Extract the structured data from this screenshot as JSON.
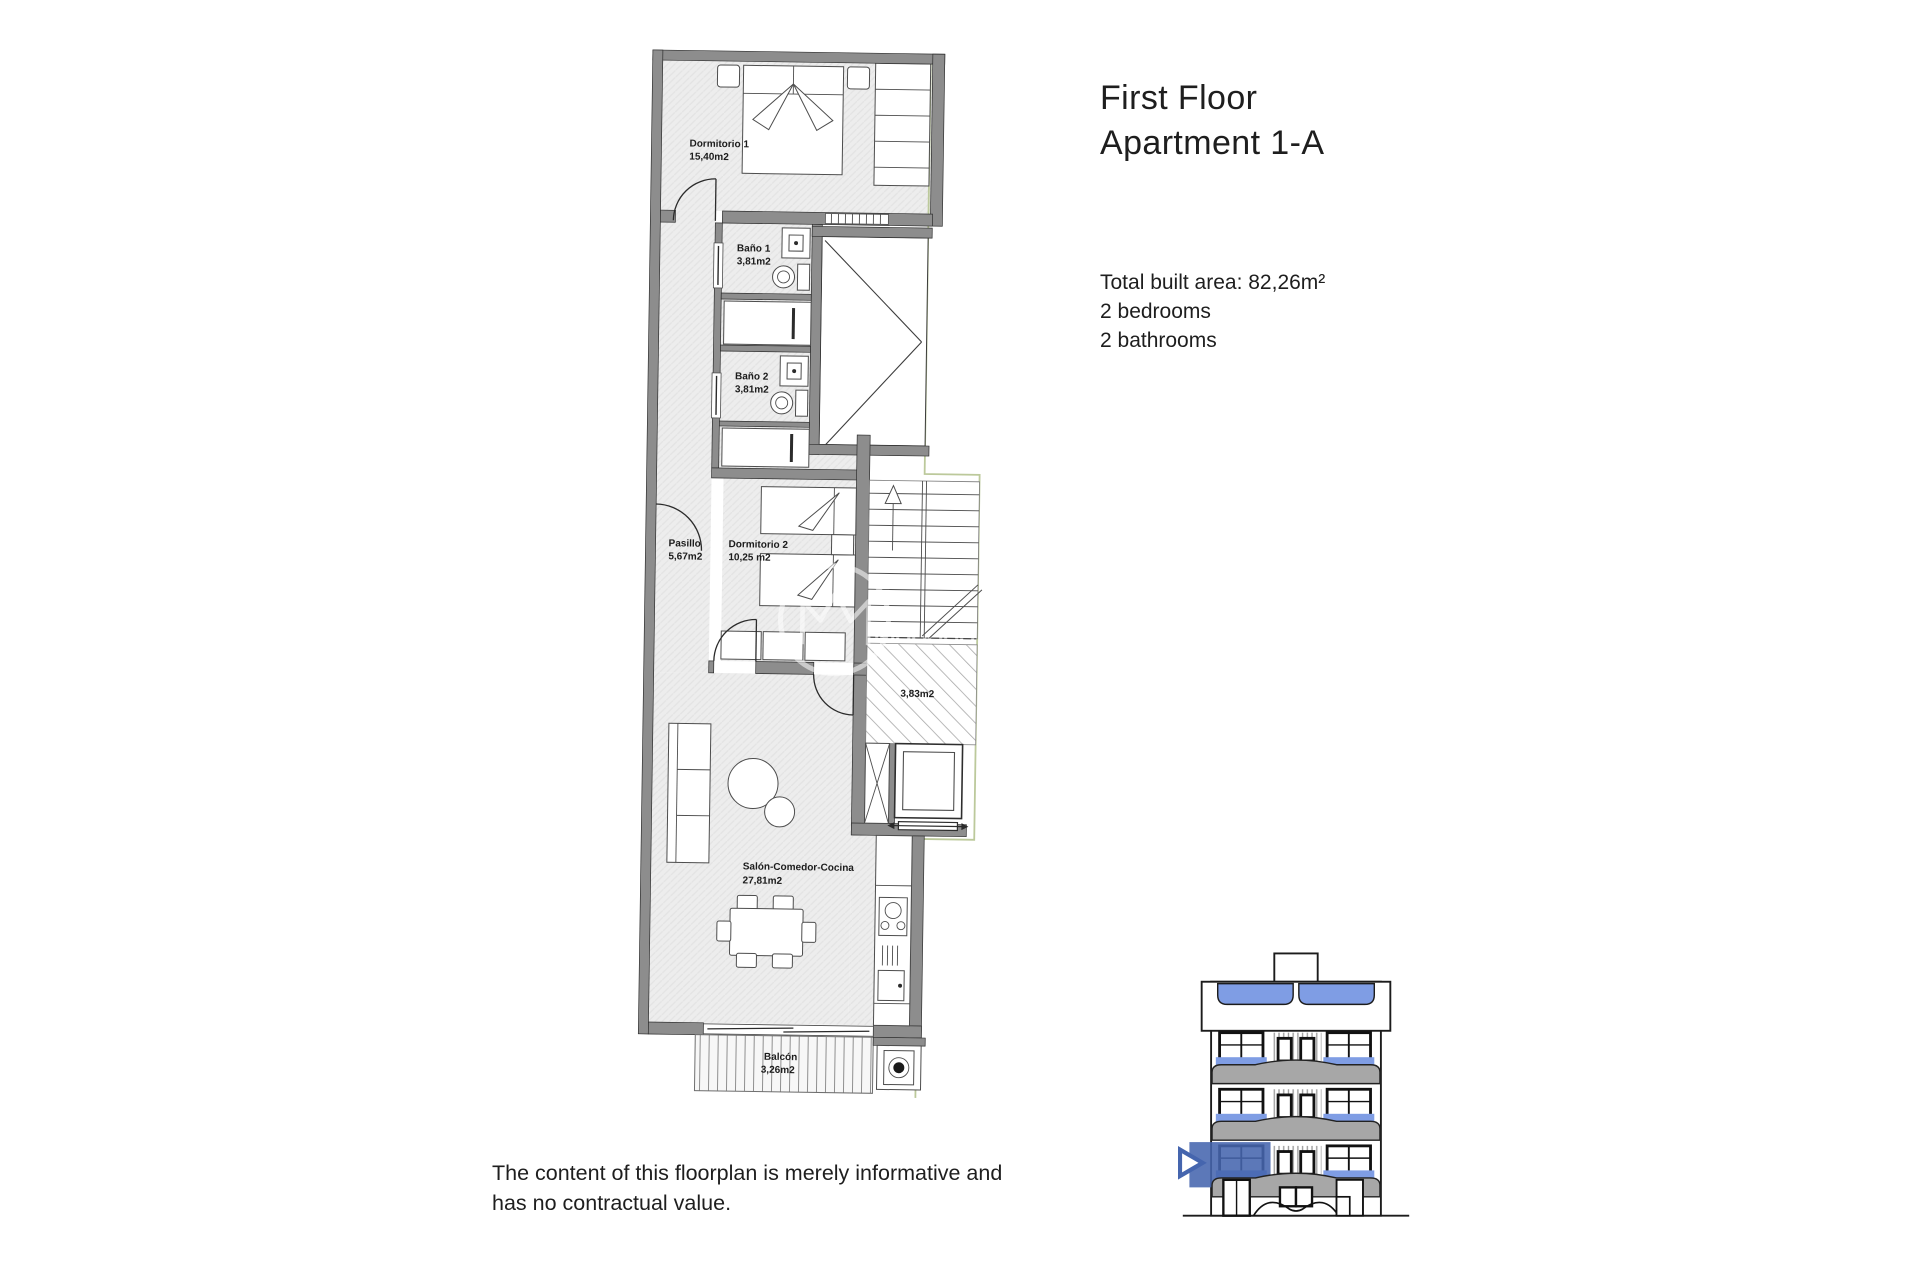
{
  "header": {
    "title_line1": "First Floor",
    "title_line2": "Apartment 1-A"
  },
  "details": {
    "total_area": "Total built area: 82,26m²",
    "bedrooms": "2 bedrooms",
    "bathrooms": "2 bathrooms"
  },
  "disclaimer": {
    "line1": "The content of this floorplan is merely informative and",
    "line2": "has no contractual value."
  },
  "floorplan": {
    "rooms": {
      "dormitorio1": {
        "name": "Dormitorio 1",
        "area": "15,40m2"
      },
      "bano1": {
        "name": "Baño 1",
        "area": "3,81m2"
      },
      "bano2": {
        "name": "Baño 2",
        "area": "3,81m2"
      },
      "pasillo": {
        "name": "Pasillo",
        "area": "5,67m2"
      },
      "dormitorio2": {
        "name": "Dormitorio 2",
        "area": "10,25 m2"
      },
      "terraza": {
        "area": "3,83m2"
      },
      "salon": {
        "name": "Salón-Comedor-Cocina",
        "area": "27,81m2"
      },
      "balcon": {
        "name": "Balcón",
        "area": "3,26m2"
      }
    }
  },
  "colors": {
    "wall_gray": "#8d8d8d",
    "floor_gray": "#ededed",
    "boundary_green": "#bcc99b",
    "highlight_blue": "#4565ae",
    "window_blue": "#7f9de4",
    "parapet_gray": "#a7a7a7"
  }
}
